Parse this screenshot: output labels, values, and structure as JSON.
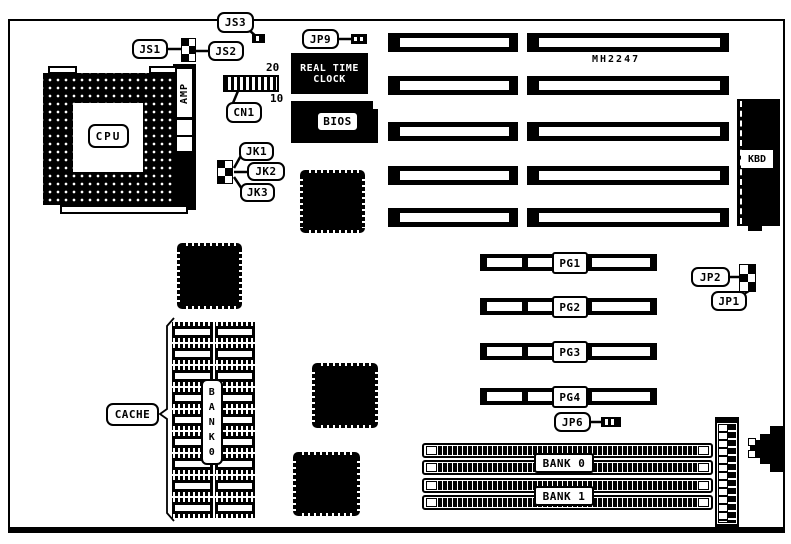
{
  "colors": {
    "ink": "#000000",
    "paper": "#ffffff"
  },
  "cpu": {
    "label": "CPU",
    "socket_brand": "AMP"
  },
  "jumpers": {
    "js1": "JS1",
    "js2": "JS2",
    "js3": "JS3",
    "jk1": "JK1",
    "jk2": "JK2",
    "jk3": "JK3",
    "jp1": "JP1",
    "jp2": "JP2",
    "jp6": "JP6",
    "jp9": "JP9"
  },
  "connectors": {
    "cn1": {
      "label": "CN1",
      "pin_top": "20",
      "pin_bottom": "10"
    },
    "kbd_label": "KBD"
  },
  "chips": {
    "rtc_line1": "REAL TIME",
    "rtc_line2": "CLOCK",
    "bios": "BIOS",
    "board_id": "MH2247"
  },
  "cache": {
    "label": "CACHE",
    "bank_vertical": "B\nA\nN\nK\n0"
  },
  "pg_slots": [
    {
      "label": "PG1"
    },
    {
      "label": "PG2"
    },
    {
      "label": "PG3"
    },
    {
      "label": "PG4"
    }
  ],
  "memory": {
    "bank0": "BANK 0",
    "bank1": "BANK 1"
  }
}
